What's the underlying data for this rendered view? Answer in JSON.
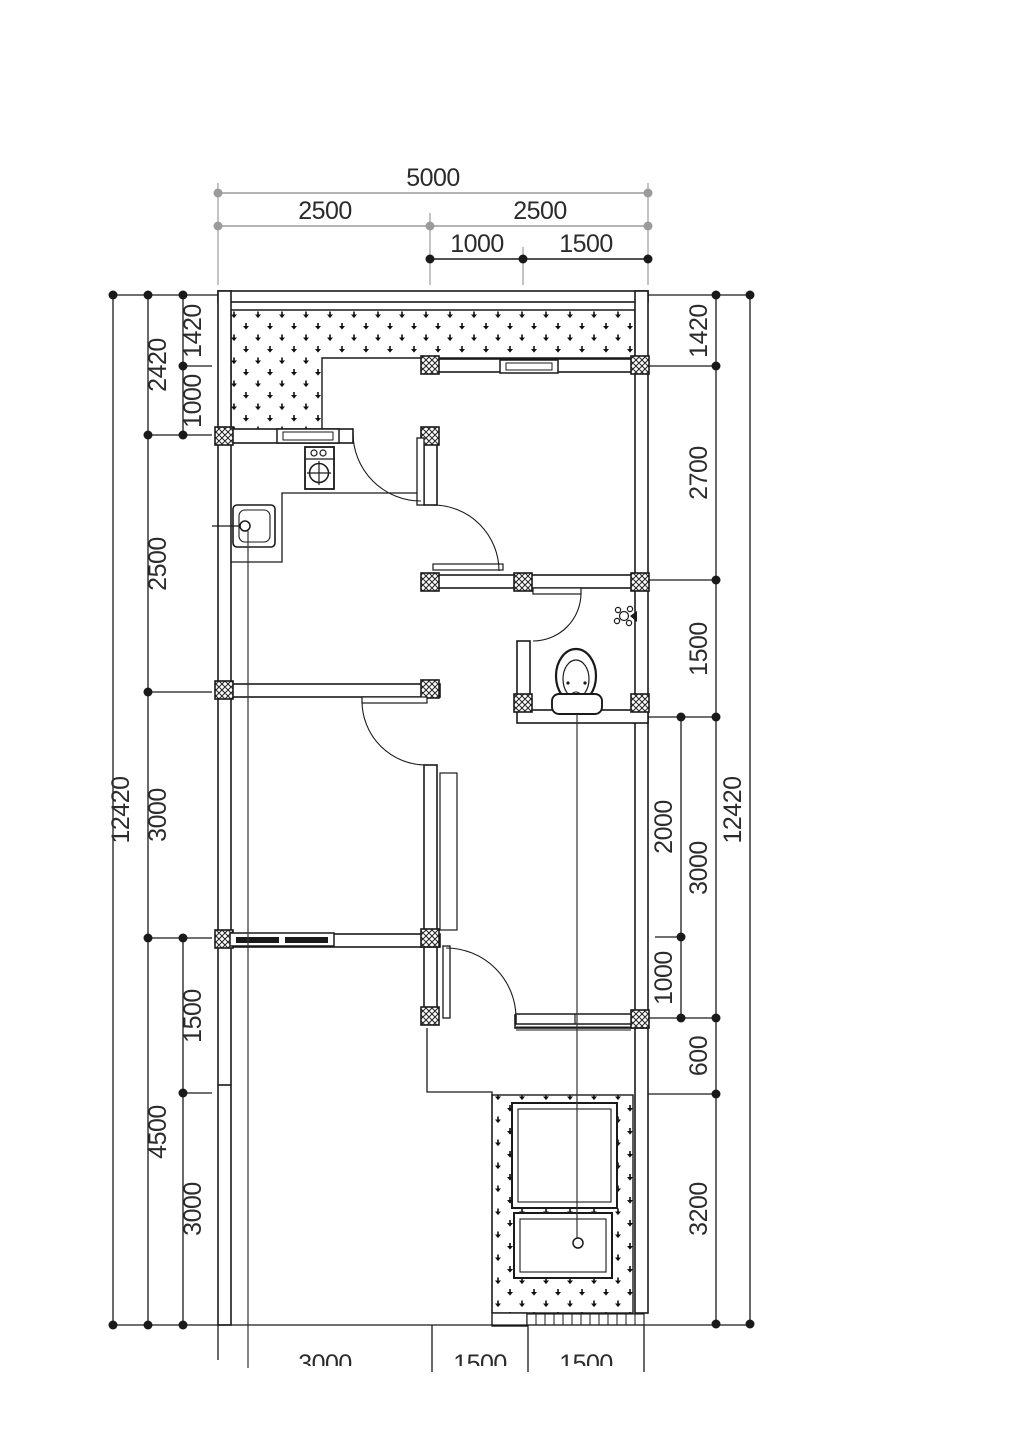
{
  "drawing": {
    "type": "house-floor-plan",
    "colors": {
      "line": "#1a1a1a",
      "gray_dim": "#9b9b9b",
      "background": "#ffffff"
    }
  },
  "dimensions": {
    "top": {
      "total": "5000",
      "row2": [
        "2500",
        "2500"
      ],
      "row3": [
        "1000",
        "1500"
      ]
    },
    "left": {
      "outer": "12420",
      "mid": [
        "2420",
        "2500",
        "3000",
        "4500"
      ],
      "inner": [
        "1420",
        "1000",
        "1500",
        "3000"
      ]
    },
    "right": {
      "outer": "12420",
      "e": [
        "1420",
        "2700",
        "1500",
        "3000",
        "600",
        "3200"
      ],
      "d": [
        "2000",
        "1000"
      ]
    },
    "bottom": [
      "3000",
      "1500",
      "1500"
    ]
  },
  "fixtures": [
    {
      "name": "stove-icon"
    },
    {
      "name": "sink-icon"
    },
    {
      "name": "toilet-icon"
    },
    {
      "name": "shower-icon"
    },
    {
      "name": "floor-drain-icon"
    }
  ]
}
